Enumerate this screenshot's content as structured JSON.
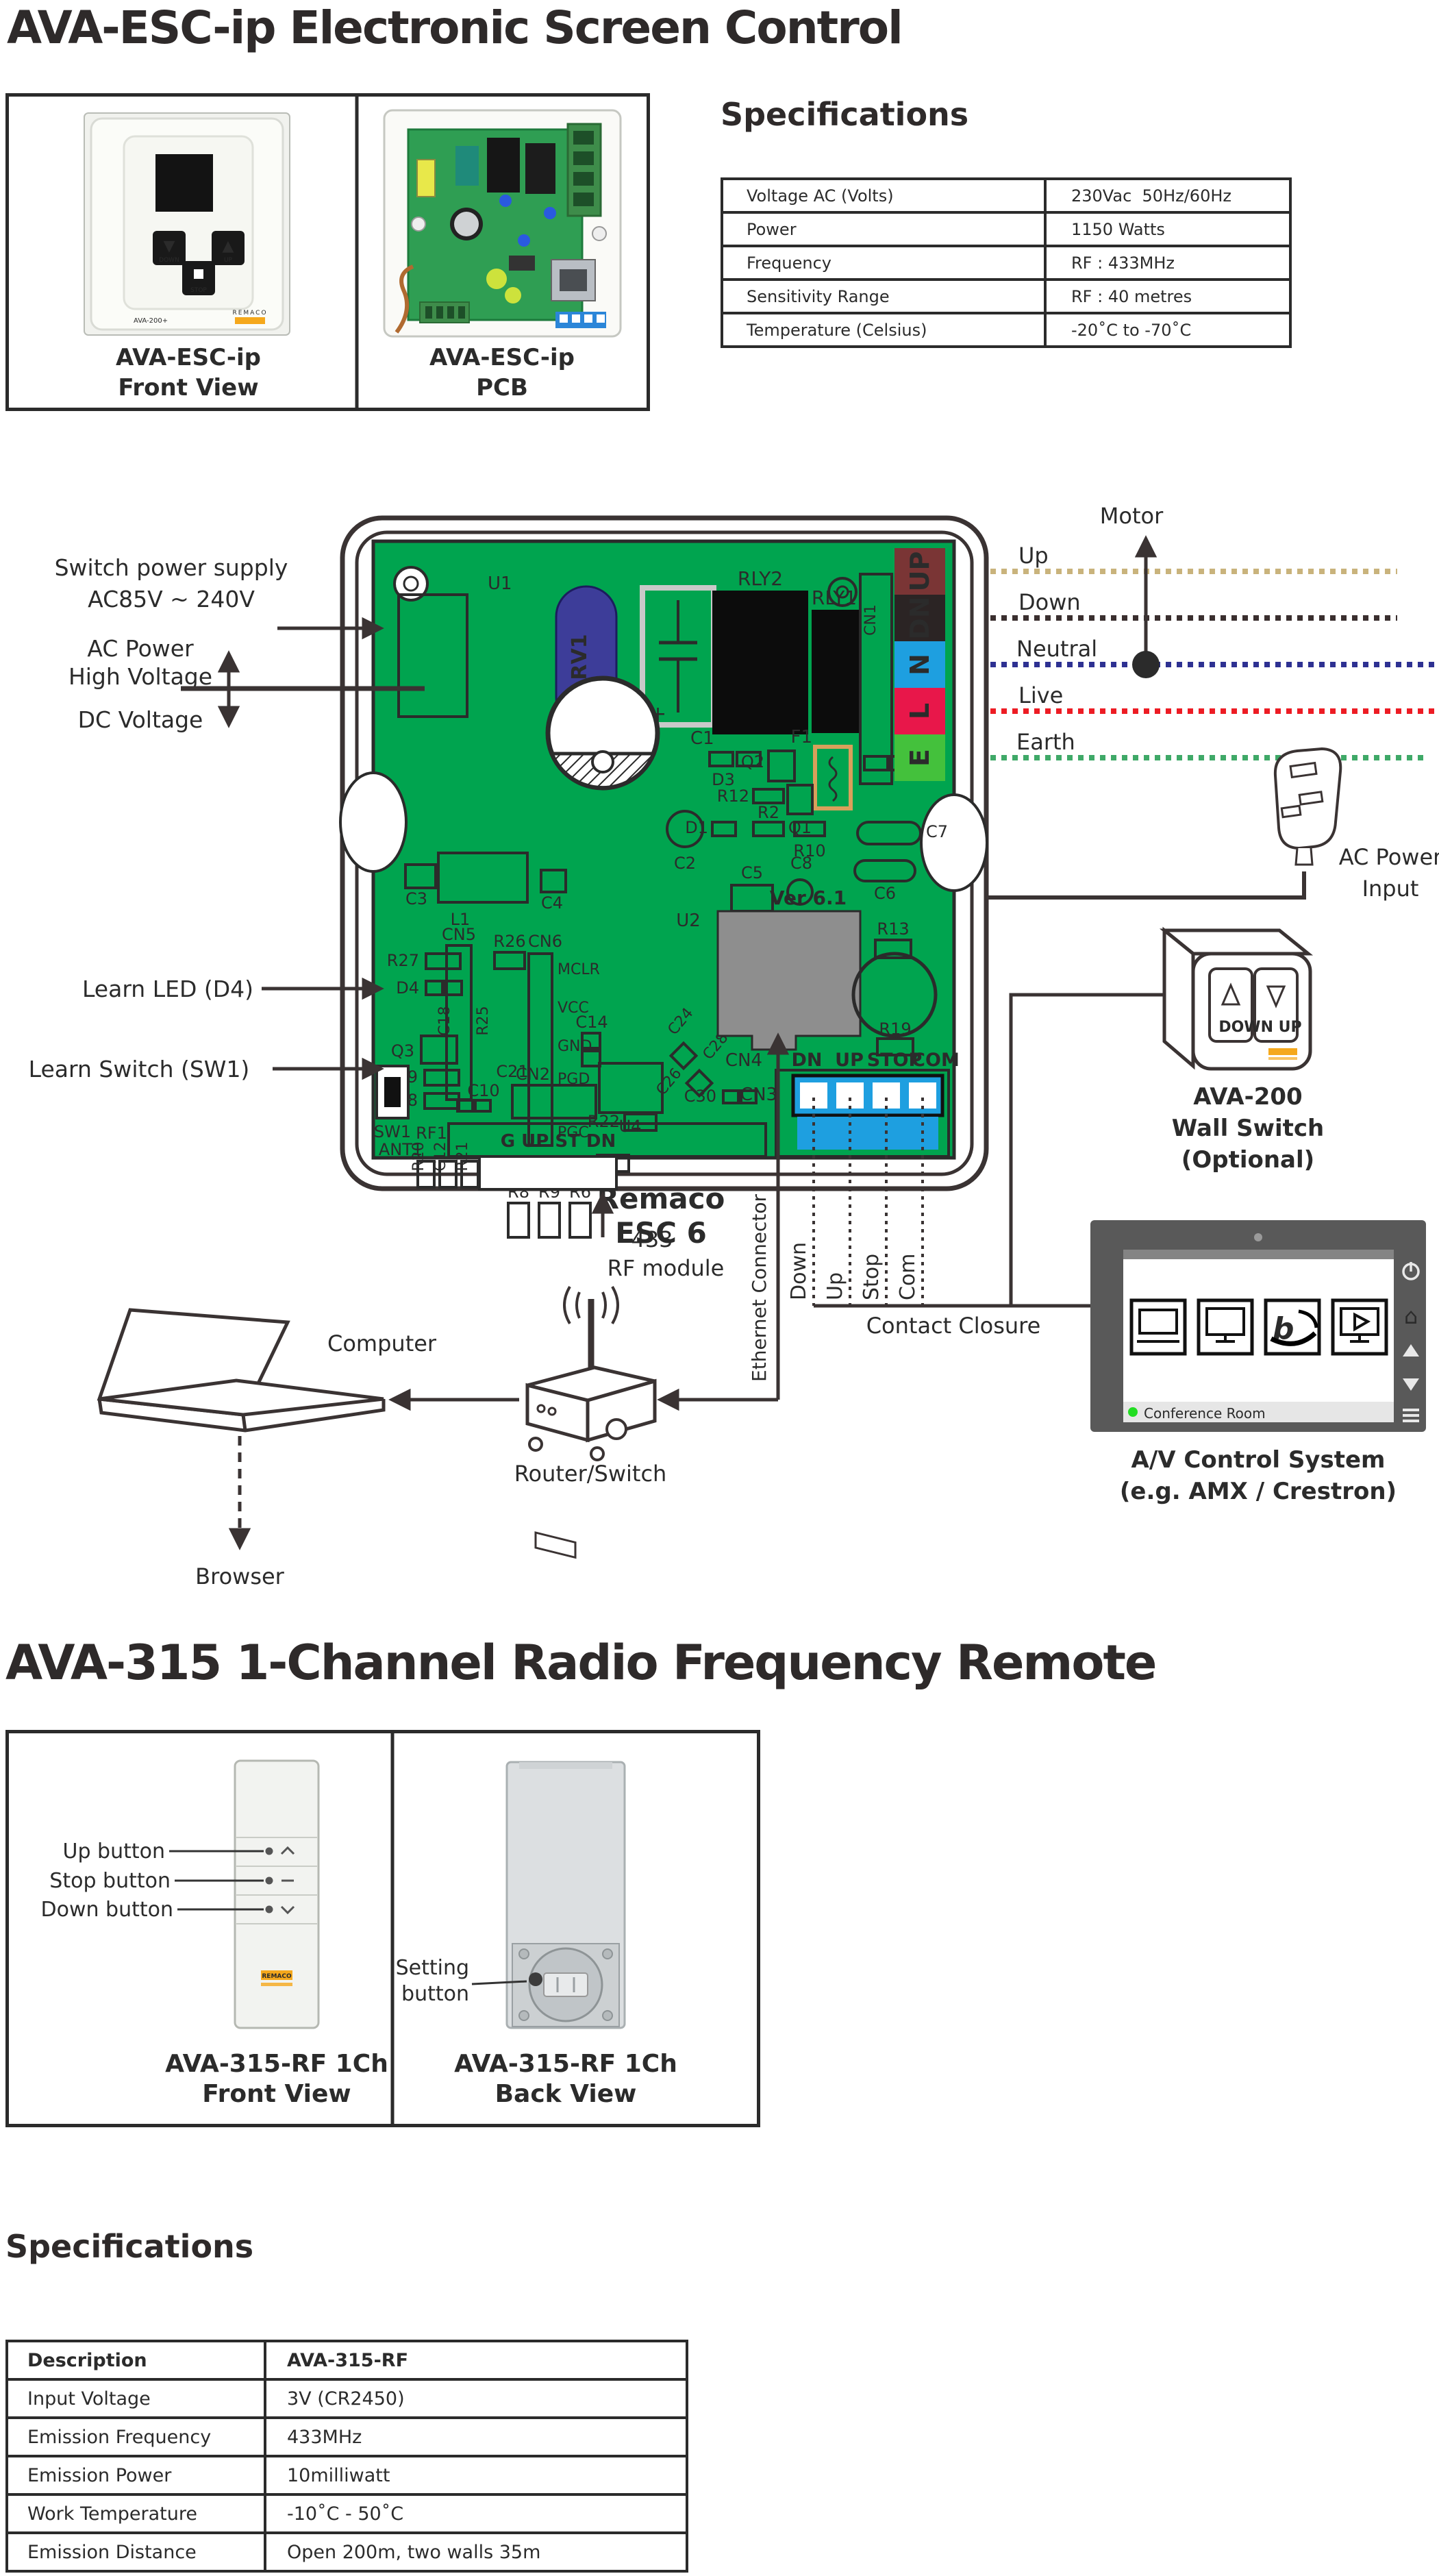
{
  "header": {
    "title": "AVA-ESC-ip Electronic Screen Control"
  },
  "product_box": {
    "front": {
      "caption_1": "AVA-ESC-ip",
      "caption_2": "Front View",
      "btn_down": "DOWN",
      "btn_stop": "STOP",
      "btn_up": "UP",
      "plate_model": "AVA-200+",
      "brand": "REMACO"
    },
    "pcb": {
      "caption_1": "AVA-ESC-ip",
      "caption_2": "PCB"
    }
  },
  "spec1": {
    "heading": "Specifications",
    "rows": [
      [
        "Voltage AC (Volts)",
        "230Vac  50Hz/60Hz"
      ],
      [
        "Power",
        "1150 Watts"
      ],
      [
        "Frequency",
        "RF : 433MHz"
      ],
      [
        "Sensitivity Range",
        "RF : 40 metres"
      ],
      [
        "Temperature (Celsius)",
        "-20˚C to -70˚C"
      ]
    ]
  },
  "diagram": {
    "labels": {
      "supply_1": "Switch power supply",
      "supply_2": "AC85V ~ 240V",
      "ac_power_1": "AC Power",
      "ac_power_2": "High Voltage",
      "dc": "DC Voltage",
      "learn_led": "Learn LED (D4)",
      "learn_switch": "Learn Switch (SW1)",
      "motor": "Motor",
      "ac_input_1": "AC Power",
      "ac_input_2": "Input",
      "rf433": "433",
      "rf_module": "RF module",
      "ethernet": "Ethernet Connector",
      "computer": "Computer",
      "router": "Router/Switch",
      "browser": "Browser"
    },
    "wires": {
      "up": "Up",
      "down": "Down",
      "neutral": "Neutral",
      "live": "Live",
      "earth": "Earth"
    },
    "terminals": {
      "up": "UP",
      "dn": "DN",
      "n": "N",
      "l": "L",
      "e": "E"
    },
    "contact": {
      "down": "Down",
      "up": "Up",
      "stop": "Stop",
      "com": "Com",
      "closure": "Contact Closure"
    },
    "wall_switch": {
      "line1": "AVA-200",
      "line2": "Wall Switch",
      "line3": "(Optional)",
      "watermark": "DOWN UP",
      "brand": "REMACO"
    },
    "avcs": {
      "line1": "A/V Control System",
      "line2": "(e.g. AMX / Crestron)",
      "status": "Conference Room"
    },
    "pcb": {
      "u1": "U1",
      "rv1": "RV1",
      "c1": "C1",
      "c1_plus": "+",
      "rly2": "RLY2",
      "rly1": "RLY1",
      "cn1": "CN1",
      "f1": "F1",
      "d3": "D3",
      "q2": "Q2",
      "r12": "R12",
      "d2": "D2",
      "q1": "Q1",
      "d1": "D1",
      "r2": "R2",
      "r10": "R10",
      "c7": "C7",
      "c2": "C2",
      "l1": "L1",
      "c3": "C3",
      "c4": "C4",
      "c5": "C5",
      "c8": "C8",
      "c6": "C6",
      "u2": "U2",
      "ver": "Ver 6.1",
      "cn5": "CN5",
      "r26": "R26",
      "cn6": "CN6",
      "mclr": "MCLR",
      "vcc": "VCC",
      "gnd": "GND",
      "pgd": "PGD",
      "pgc": "PGC",
      "r27": "R27",
      "d4": "D4",
      "c18": "C18",
      "r25": "R25",
      "q3": "Q3",
      "r29": "R29",
      "r28": "R28",
      "c21": "C21",
      "c14": "C14",
      "r22": "R22",
      "r23": "R23",
      "u4": "U4",
      "c24": "C24",
      "c26": "C26",
      "c28": "C28",
      "r13": "R13",
      "r19": "R19",
      "r20": "R20",
      "c12": "C12",
      "r21": "R21",
      "r8": "R8",
      "r9": "R9",
      "r6": "R6",
      "brand_1": "Remaco",
      "brand_2": "ESC 6",
      "cn4": "CN4",
      "cn2": "CN2",
      "c10": "C10",
      "c30": "C30",
      "cn3": "CN3",
      "sw1": "SW1",
      "ant1": "ANT1",
      "rf1": "RF1",
      "bottom_conn": "G UP ST DN",
      "hdr_dn": "DN",
      "hdr_up": "UP",
      "hdr_stop": "STOP",
      "hdr_com": "COM"
    },
    "colors": {
      "pcb_green": "#00A44F",
      "line_dark": "#3A3333",
      "terminal_up": "#7A3535",
      "terminal_dn": "#2B2424",
      "terminal_n": "#1E9FE0",
      "terminal_l": "#E8174A",
      "terminal_e": "#44C13C",
      "wire_up": "#C9B37C",
      "wire_down": "#3A2F2F",
      "wire_neutral": "#2E3192",
      "wire_live": "#ED1C24",
      "wire_earth": "#3FA968",
      "fuse_orange": "#D9A05B",
      "rv1_blue": "#3D3D99",
      "cn3_blue": "#1E9FE0",
      "cn4_gray": "#8E8E8E",
      "logo_orange": "#F5A81C",
      "panel_gray": "#595959",
      "status_green": "#22DD22"
    }
  },
  "ava315": {
    "title": "AVA-315 1-Channel Radio Frequency Remote",
    "front": {
      "caption_1": "AVA-315-RF 1Ch",
      "caption_2": "Front View",
      "label_up": "Up button",
      "label_stop": "Stop button",
      "label_down": "Down button",
      "brand": "REMACO"
    },
    "back": {
      "caption_1": "AVA-315-RF 1Ch",
      "caption_2": "Back View",
      "label_setting_1": "Setting",
      "label_setting_2": "button"
    }
  },
  "spec2": {
    "heading": "Specifications",
    "rows": [
      [
        "Description",
        "AVA-315-RF"
      ],
      [
        "Input Voltage",
        "3V (CR2450)"
      ],
      [
        "Emission Frequency",
        "433MHz"
      ],
      [
        "Emission Power",
        "10milliwatt"
      ],
      [
        "Work Temperature",
        "-10˚C - 50˚C"
      ],
      [
        "Emission Distance",
        "Open 200m, two walls 35m"
      ]
    ]
  }
}
